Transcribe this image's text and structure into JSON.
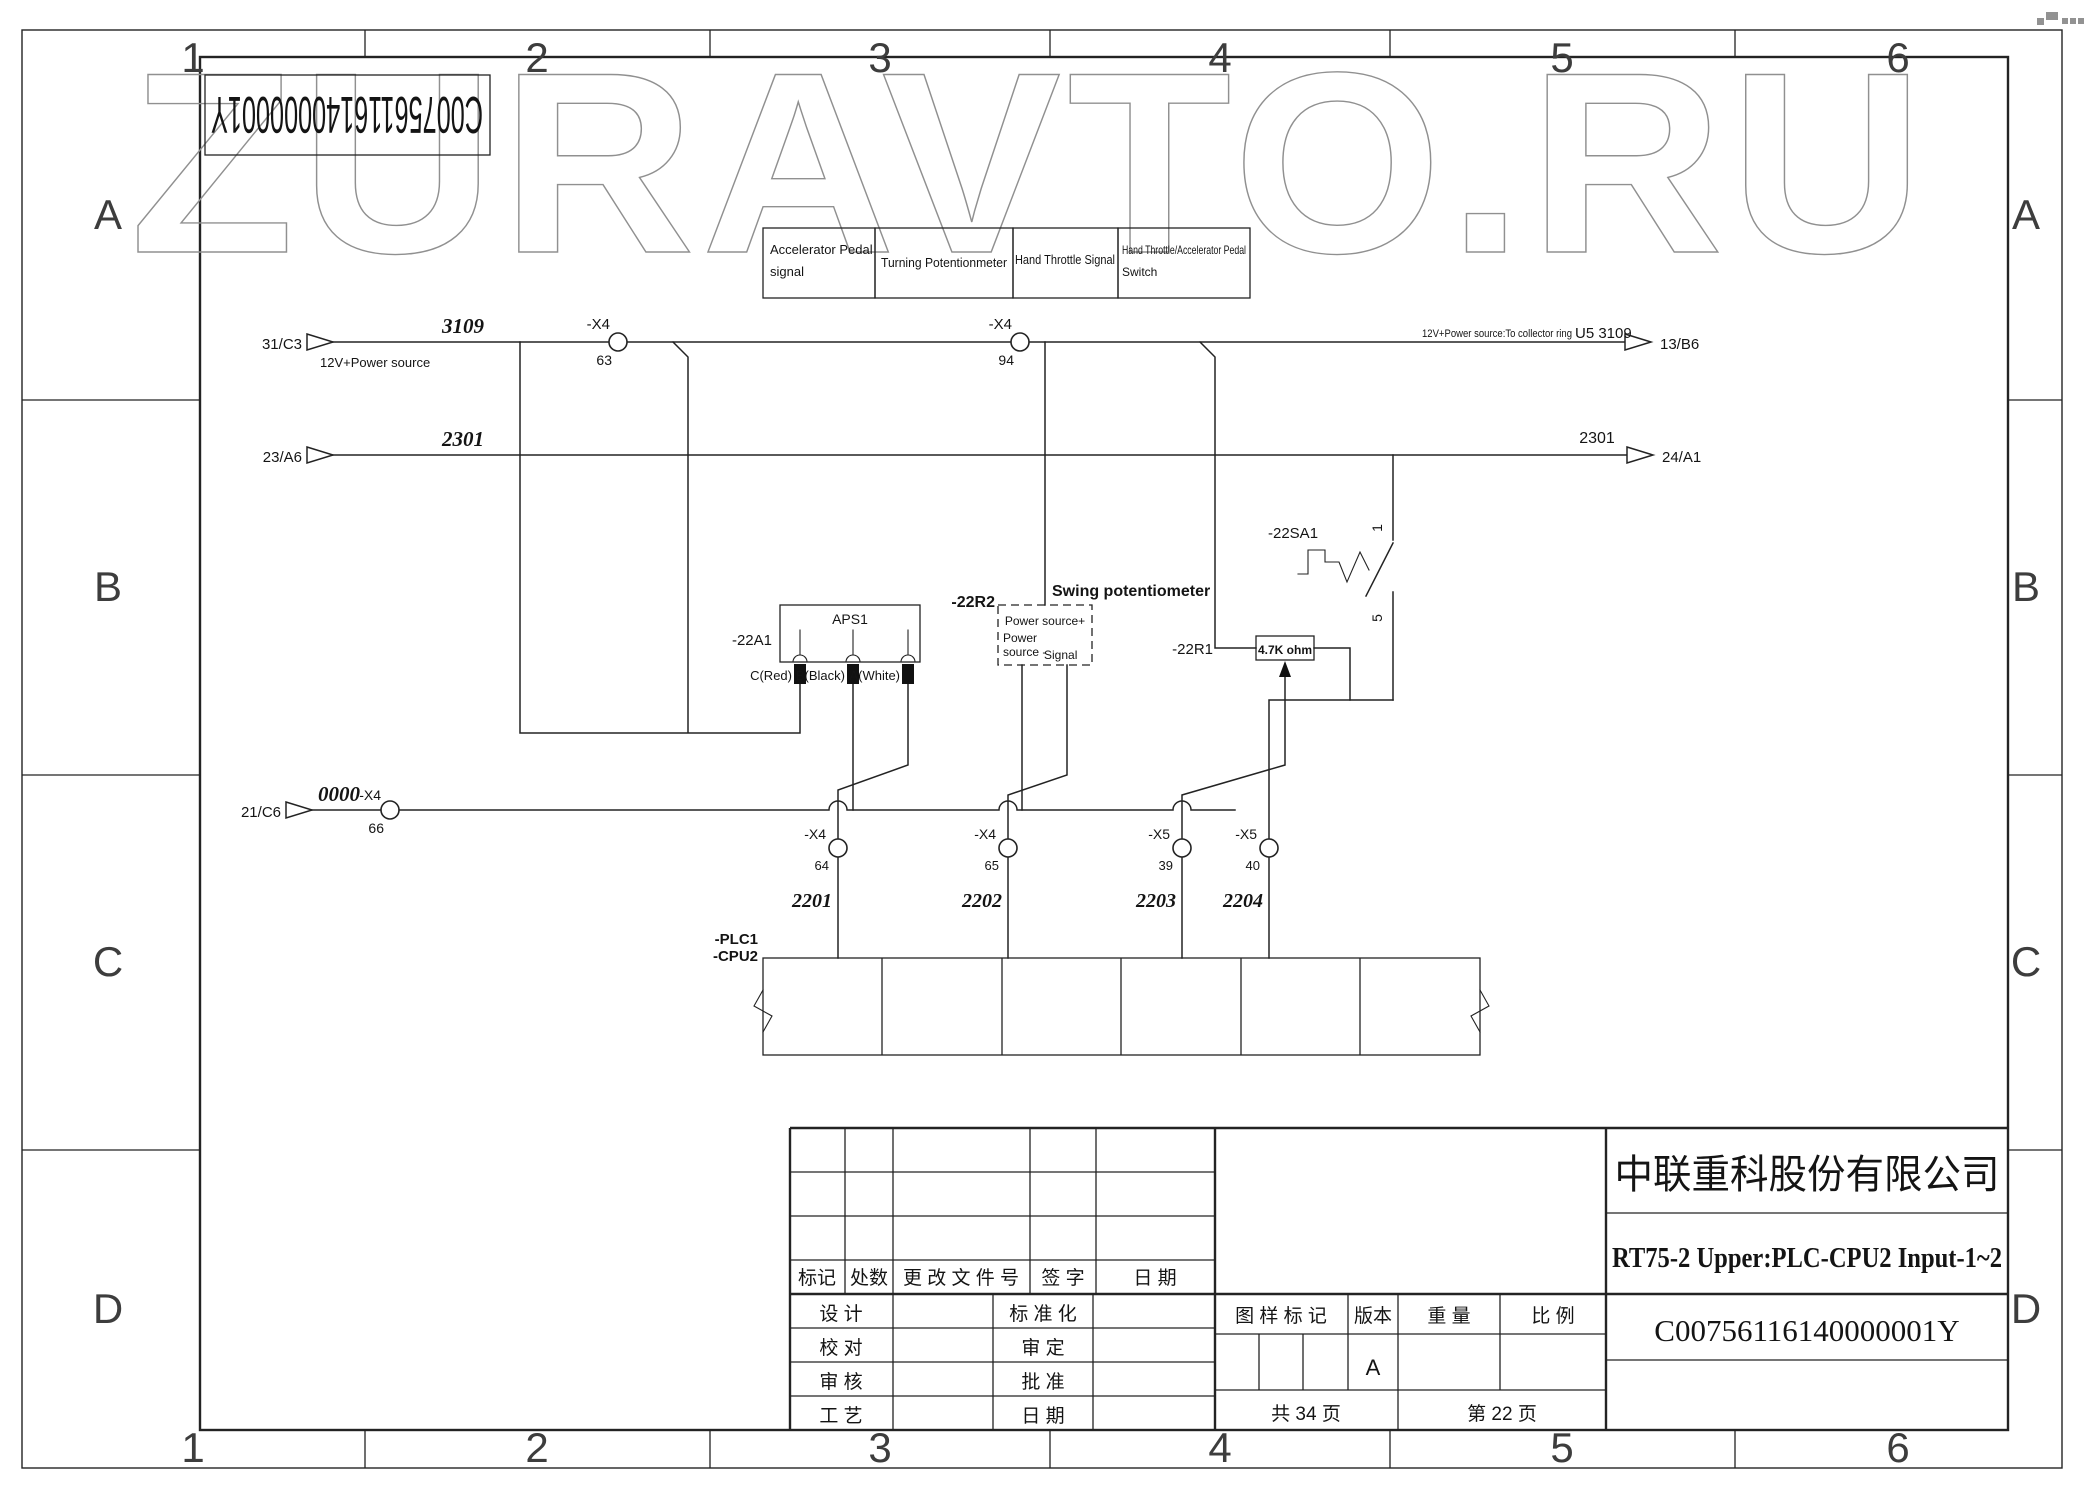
{
  "watermark": "ZURAVTO.RU",
  "corner_code_flipped": "C00756116140000001Y",
  "signal_boxes": [
    {
      "line1": "Accelerator Pedal",
      "line2": "signal"
    },
    {
      "line1": "Turning Potentionmeter",
      "line2": ""
    },
    {
      "line1": "Hand Throttle Signal",
      "line2": ""
    },
    {
      "line1": "Hand Throttle/Accelerator Pedal",
      "line2": "Switch"
    }
  ],
  "nets": {
    "n3109": {
      "src": "31/C3",
      "src_note": "12V+Power source",
      "wire": "3109",
      "conn_a": "-X4",
      "pin_a": "63",
      "conn_b": "-X4",
      "pin_b": "94",
      "dest_note": "12V+Power source:To collector ring",
      "dest_ref": "U5 3109",
      "dest": "13/B6"
    },
    "n2301": {
      "src": "23/A6",
      "wire": "2301",
      "wire_end": "2301",
      "dest": "24/A1"
    },
    "n0000": {
      "src": "21/C6",
      "wire": "0000",
      "conn": "-X4",
      "pin": "66"
    }
  },
  "components": {
    "aps": {
      "ref": "-22A1",
      "name": "APS1",
      "pin_c": "C(Red)",
      "pin_b": "B(Black)",
      "pin_a": "A(White)"
    },
    "pot": {
      "ref": "-22R2",
      "title": "Swing potentiometer",
      "pin_plus": "Power source+",
      "pin_minus_1": "Power",
      "pin_minus_2": "source -",
      "pin_signal": "Signal"
    },
    "res": {
      "ref": "-22R1",
      "value": "4.7K ohm"
    },
    "sw": {
      "ref": "-22SA1",
      "term_top": "1",
      "term_bottom": "5"
    },
    "plc": {
      "ref1": "-PLC1",
      "ref2": "-CPU2"
    }
  },
  "plc_inputs": [
    {
      "conn": "-X4",
      "pin": "64",
      "wire": "2201"
    },
    {
      "conn": "-X4",
      "pin": "65",
      "wire": "2202"
    },
    {
      "conn": "-X5",
      "pin": "39",
      "wire": "2203"
    },
    {
      "conn": "-X5",
      "pin": "40",
      "wire": "2204"
    }
  ],
  "title_block": {
    "company": "中联重科股份有限公司",
    "drawing_title": "RT75-2 Upper:PLC-CPU2 Input-1~2",
    "drawing_no": "C00756116140000001Y"
  },
  "rev_table": {
    "h1": "标记",
    "h2": "处数",
    "h3": "更 改 文 件 号",
    "h4": "签  字",
    "h5": "日 期",
    "r1": "设  计",
    "r2": "校  对",
    "r3": "审  核",
    "r4": "工  艺",
    "s1": "标 准 化",
    "s2": "审  定",
    "s3": "批  准",
    "s4": "日  期"
  },
  "info_table": {
    "h1": "图 样 标 记",
    "h2": "版本",
    "h3": "重 量",
    "h4": "比 例",
    "version_a": "A",
    "total": "共  34  页",
    "page": "第  22  页"
  },
  "zones": {
    "c1": "1",
    "c2": "2",
    "c3": "3",
    "c4": "4",
    "c5": "5",
    "c6": "6",
    "r1": "A",
    "r2": "B",
    "r3": "C",
    "r4": "D"
  }
}
